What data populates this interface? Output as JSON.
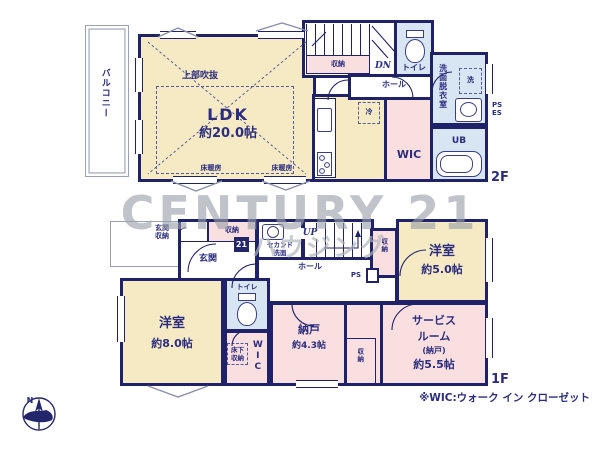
{
  "meta": {
    "type": "floor-plan"
  },
  "colors": {
    "wall": "#1f2268",
    "room_yellow": "#f6eac5",
    "room_pink": "#fadfe1",
    "room_blue": "#d8e5f3",
    "text_navy": "#2b2d7e",
    "watermark_gray": "#9aa0a9"
  },
  "watermark": {
    "brand": "CENTURY 21",
    "company": "ハウジング",
    "logo": "21"
  },
  "footnote": "※WIC:ウォーク イン クローゼット",
  "compass": {
    "north": "N"
  },
  "floor2": {
    "tag": "2F",
    "balcony": "バルコニー",
    "open_ceiling": "上部吹抜",
    "ldk_name": "LDK",
    "ldk_size": "約20.0帖",
    "floor_heating": "床暖房",
    "storage": "収納",
    "down": "DN",
    "toilet": "トイレ",
    "hall": "ホール",
    "fridge": "冷",
    "wic": "WIC",
    "washroom": "洗面脱衣室",
    "washer": "洗",
    "ps": "PS",
    "es": "ES",
    "bath": "UB"
  },
  "floor1": {
    "tag": "1F",
    "entrance_storage_l1": "玄関",
    "entrance_storage_l2": "収納",
    "entrance": "玄関",
    "storage": "収納",
    "second_basin_l1": "セカンド",
    "second_basin_l2": "洗面",
    "up": "UP",
    "hall": "ホール",
    "ps": "PS",
    "toilet": "トイレ",
    "bedroom_b_name": "洋室",
    "bedroom_b_size": "約5.0帖",
    "bedroom_a_name": "洋室",
    "bedroom_a_size": "約8.0帖",
    "underfloor_l1": "床下",
    "underfloor_l2": "収納",
    "wic": "WIC",
    "storeroom_name": "納戸",
    "storeroom_size": "約4.3帖",
    "service_l1": "サービス",
    "service_l2": "ルーム",
    "service_l3": "(納戸)",
    "service_l4": "約5.5帖"
  }
}
